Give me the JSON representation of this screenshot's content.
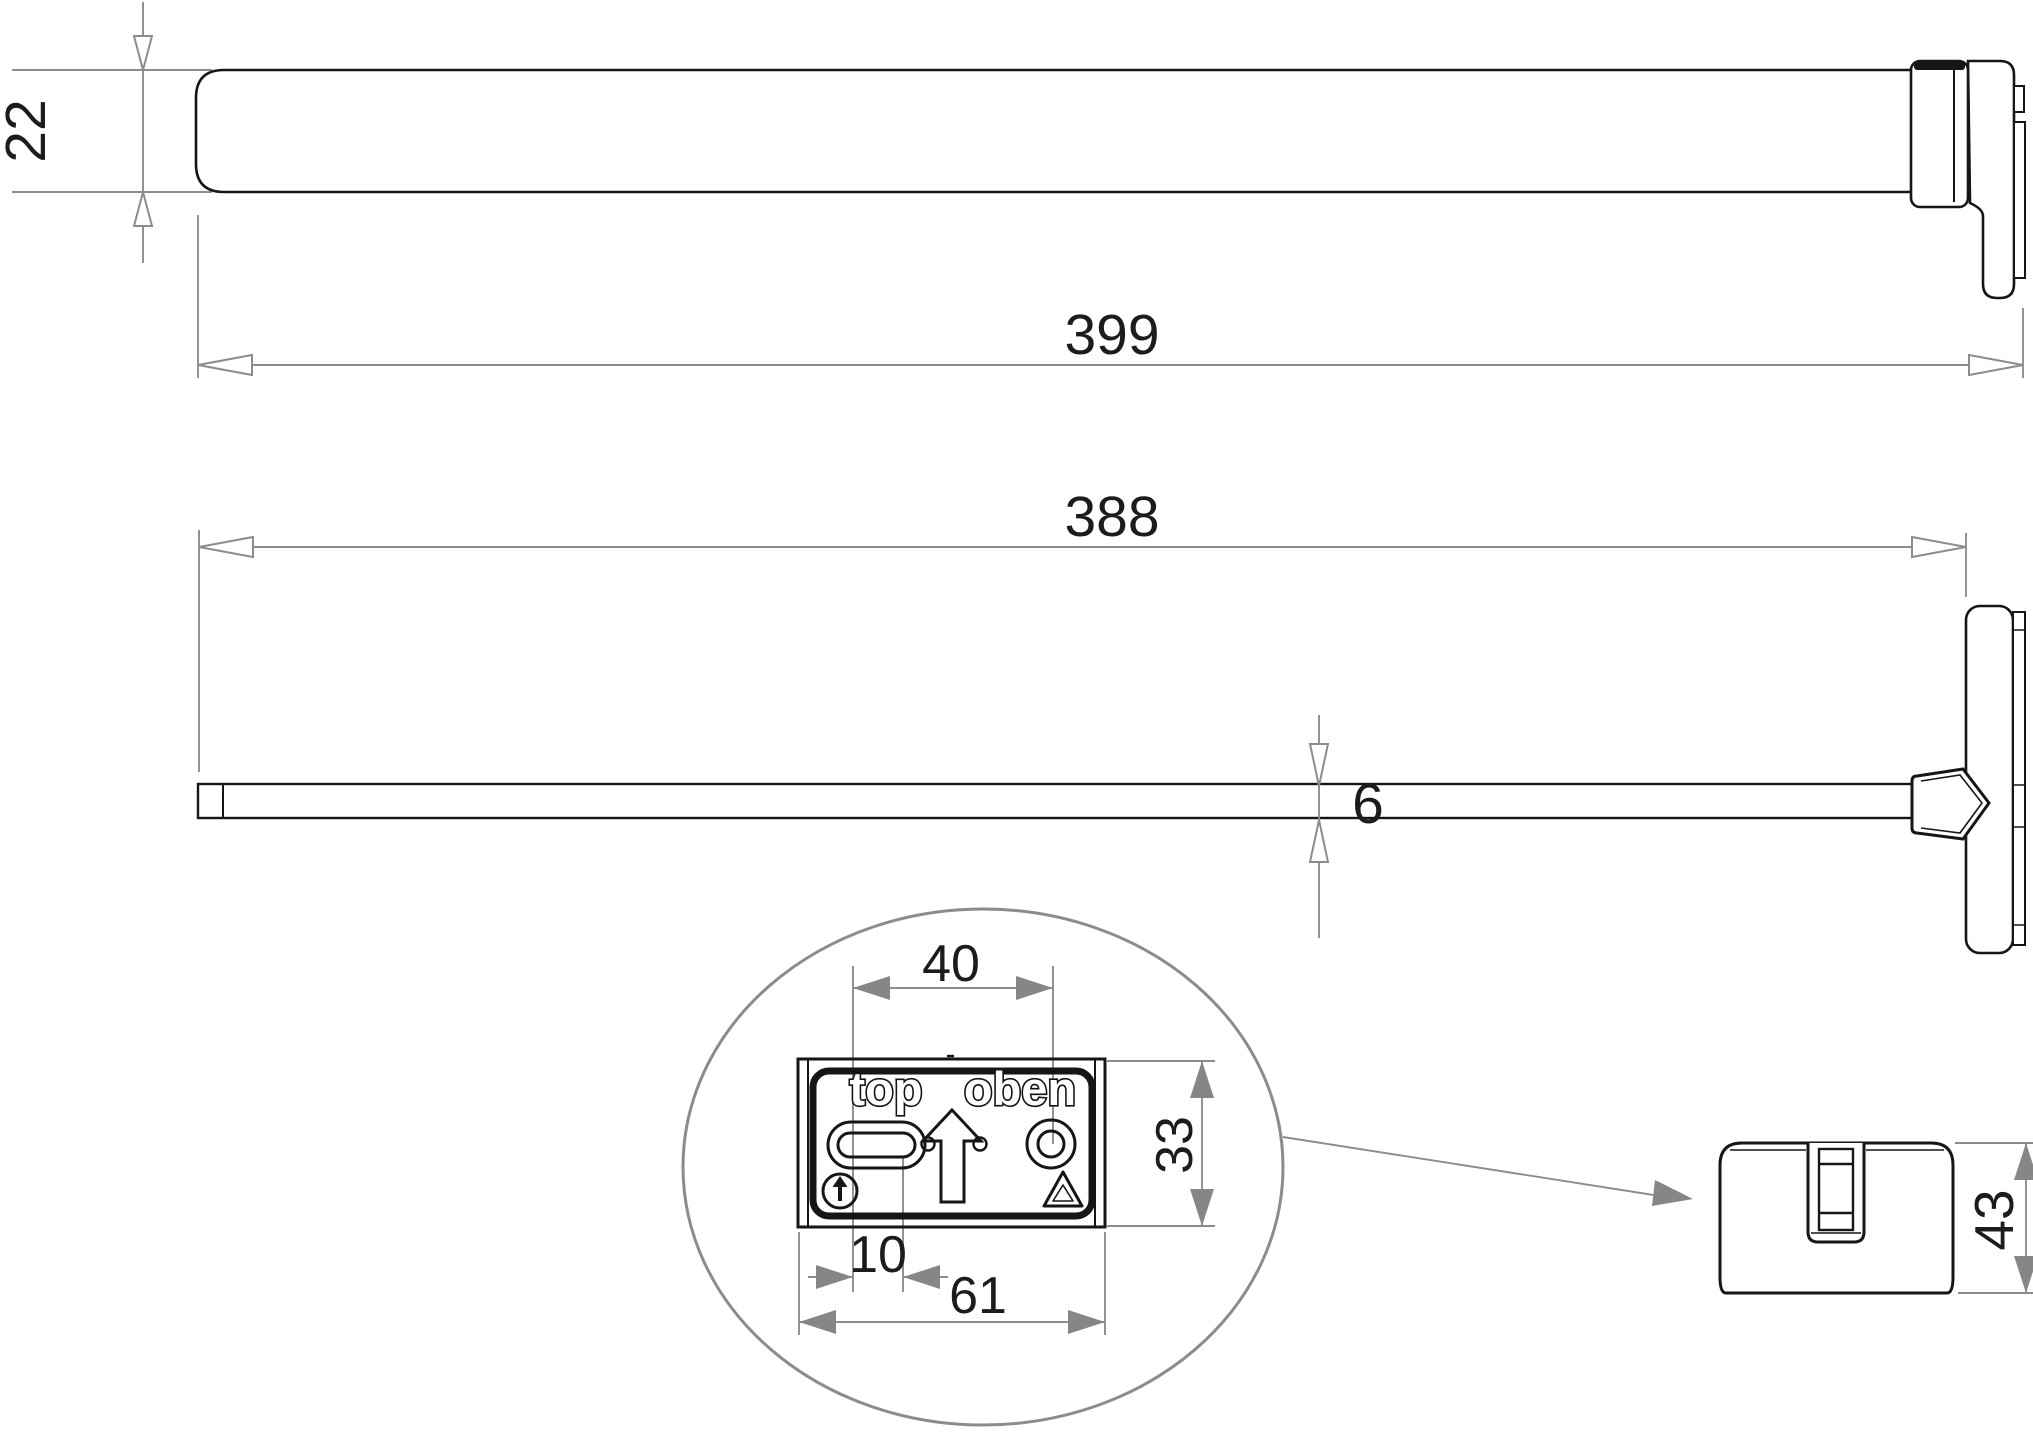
{
  "drawing": {
    "kind": "technical dimensional drawing",
    "views": {
      "top_view": {
        "dims": {
          "bar_height": "22",
          "overall_length": "399"
        }
      },
      "side_view": {
        "dims": {
          "bar_length": "388",
          "bar_thickness": "6"
        }
      },
      "detail_view": {
        "dims": {
          "slot_to_hole": "40",
          "plate_height": "33",
          "slot_length": "10",
          "plate_width": "61"
        },
        "plate_labels": {
          "left": "top",
          "right": "oben"
        },
        "icons": [
          "oblong-slot",
          "up-arrow",
          "round-hole",
          "this-way-up-icon",
          "recycling-icon"
        ]
      },
      "end_view": {
        "dims": {
          "cap_height": "43"
        }
      }
    },
    "colors": {
      "outline": "#161616",
      "dimension_lines": "#8c8c8c",
      "dimension_text": "#1c1c1c",
      "background": "#ffffff"
    }
  }
}
